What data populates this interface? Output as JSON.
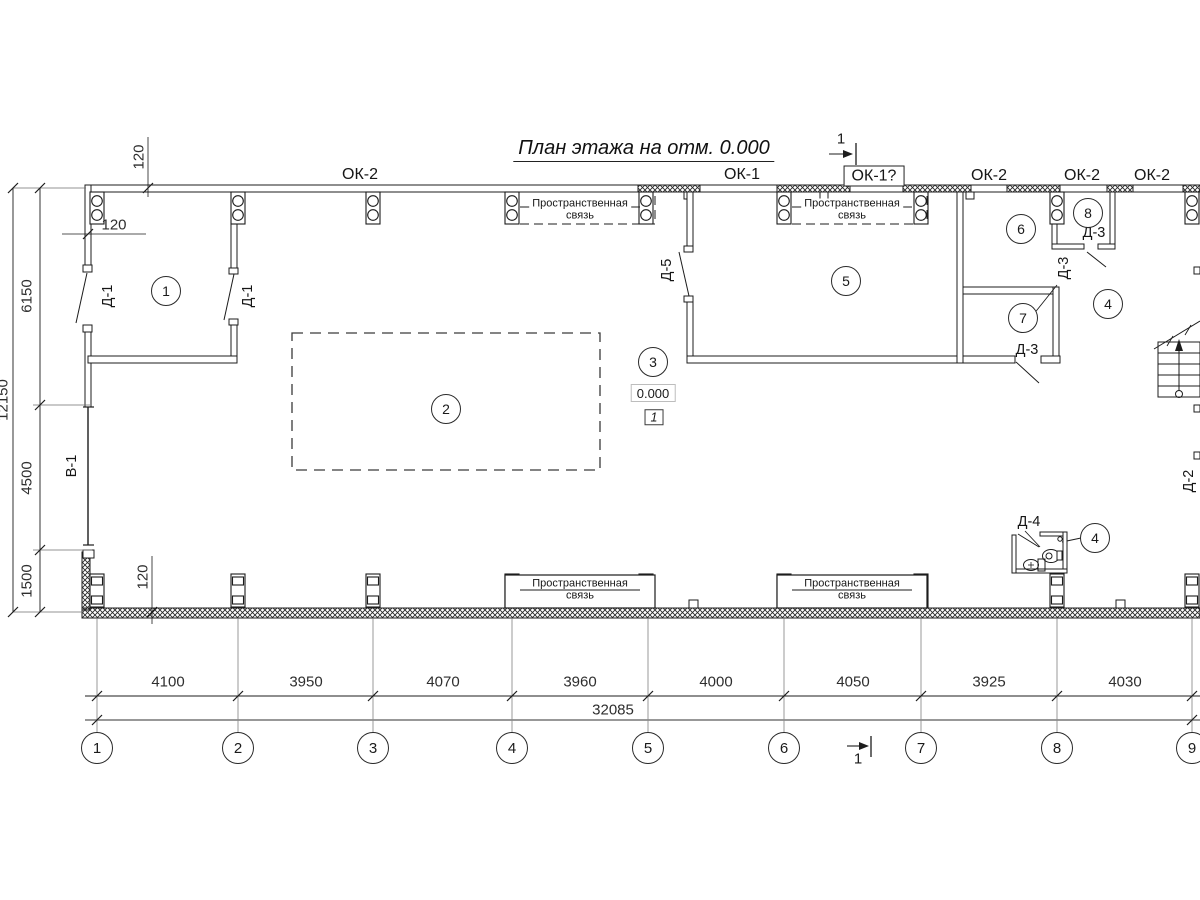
{
  "title": "План этажа на отм. 0.000",
  "section_mark": "1",
  "elevation": {
    "value": "0.000",
    "marker": "1"
  },
  "windows": {
    "ok2": "ОК-2",
    "ok1": "ОК-1",
    "ok1_question": "ОК-1?"
  },
  "doors": {
    "d1": "Д-1",
    "d2": "Д-2",
    "d3": "Д-3",
    "d4": "Д-4",
    "d5": "Д-5"
  },
  "gate_label": "В-1",
  "rooms": {
    "r1": "1",
    "r2": "2",
    "r3": "3",
    "r4": "4",
    "r5": "5",
    "r6": "6",
    "r7": "7",
    "r8": "8"
  },
  "brace": {
    "line1": "Пространственная",
    "line2": "связь"
  },
  "dims": {
    "offset": "120",
    "left_segments": [
      "6150",
      "4500",
      "1500"
    ],
    "left_total": "12150",
    "bottom_segments": [
      "4100",
      "3950",
      "4070",
      "3960",
      "4000",
      "4050",
      "3925",
      "4030"
    ],
    "bottom_total": "32085",
    "axes": [
      "1",
      "2",
      "3",
      "4",
      "5",
      "6",
      "7",
      "8",
      "9"
    ]
  }
}
